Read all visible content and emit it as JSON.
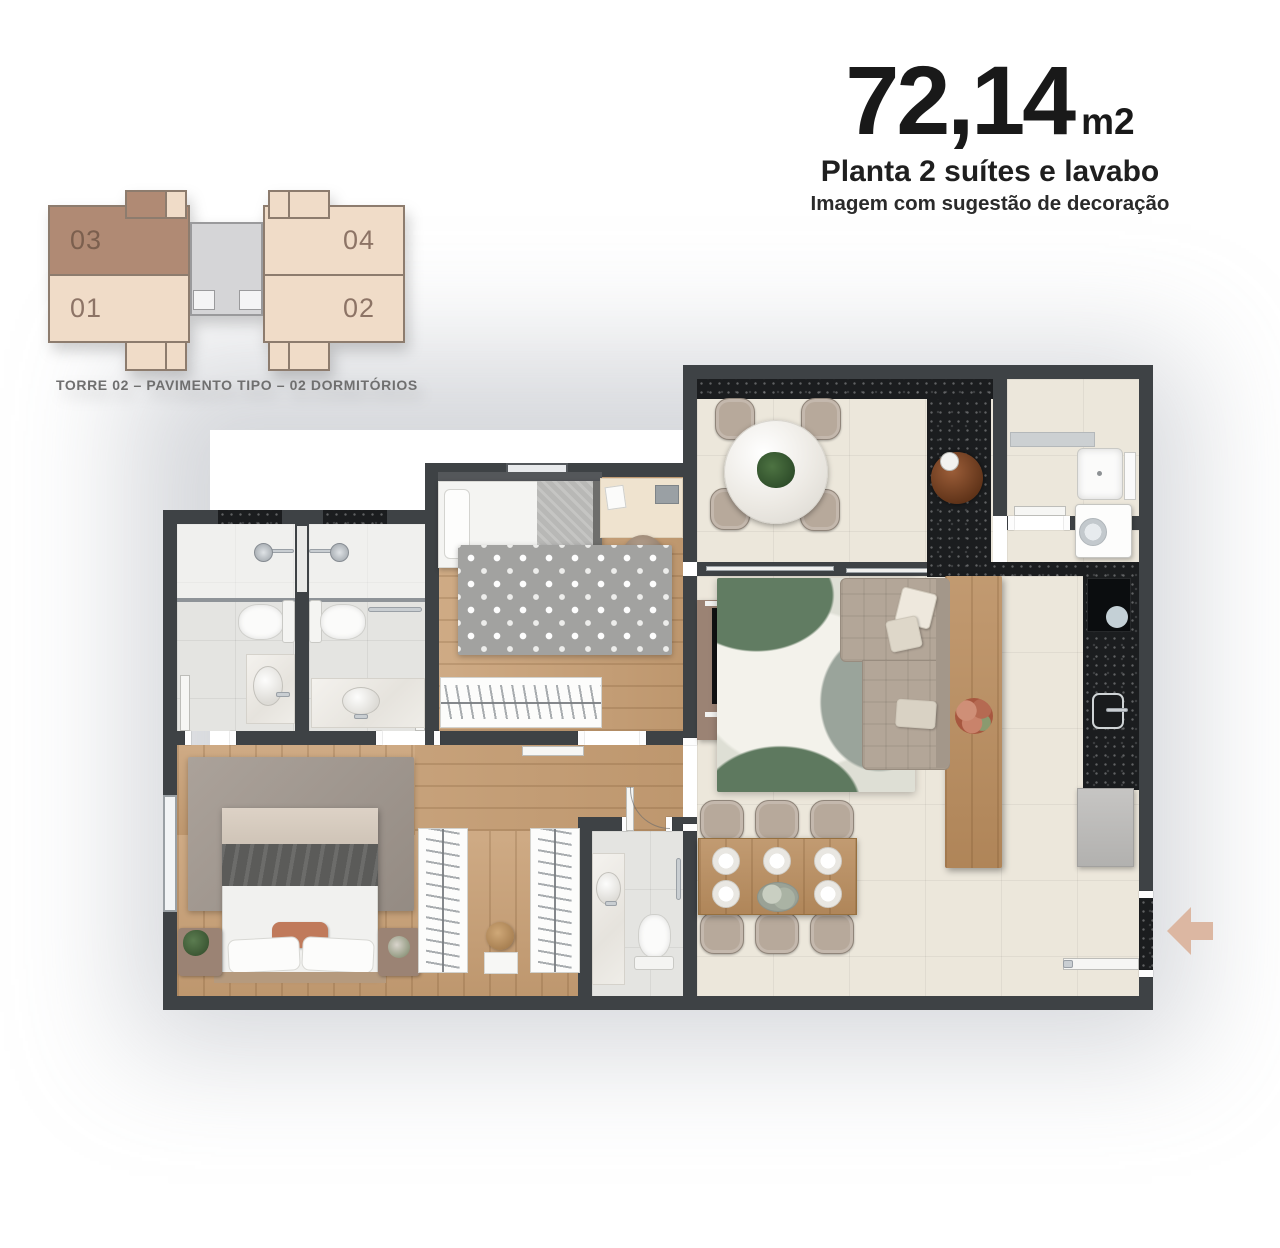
{
  "title": {
    "area_value": "72,14",
    "area_unit": "m2",
    "subtitle": "Planta 2 suítes e lavabo",
    "note": "Imagem com sugestão de decoração"
  },
  "keyplan": {
    "units": [
      {
        "id": "03",
        "highlighted": true
      },
      {
        "id": "01",
        "highlighted": false
      },
      {
        "id": "04",
        "highlighted": false
      },
      {
        "id": "02",
        "highlighted": false
      }
    ],
    "caption": "TORRE 02 – PAVIMENTO TIPO – 02 DORMITÓRIOS"
  },
  "icons": {
    "entrance_arrow": "left-arrow"
  },
  "colors": {
    "wall": "#3e4245",
    "wood": "#c89f74",
    "tile": "#ece7db",
    "bath": "#e4e4e1",
    "granite": "#1b1d1f",
    "arrow": "#dcb7a2",
    "unit-hl": "#b08a74",
    "unit-light": "#f0dcc8",
    "core": "#d5d5d7",
    "ink": "#191919",
    "muted": "#6f6f6f"
  }
}
